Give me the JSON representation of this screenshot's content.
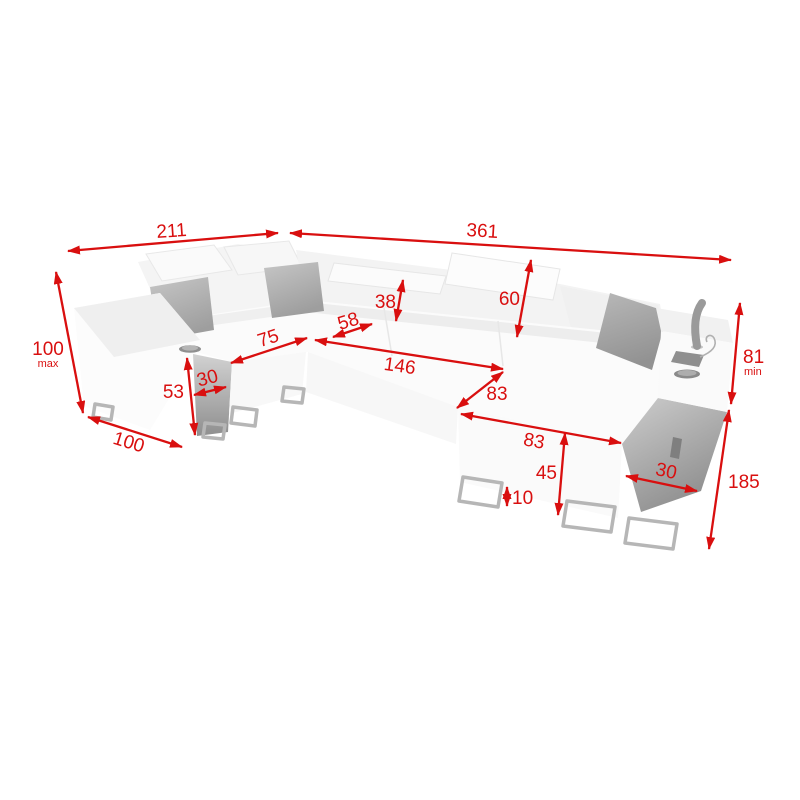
{
  "accent_color": "#d90f0f",
  "colors": {
    "sofa_light": "#fbfbfb",
    "sofa_shadow": "#ededed",
    "pillow_gray": "#ababab",
    "console_gray": "#9a9a9a",
    "metal_gray": "#b6b6b6"
  },
  "dims": {
    "w_left": {
      "value": "211"
    },
    "w_right": {
      "value": "361"
    },
    "h_back_max": {
      "value": "100",
      "qualifier": "max"
    },
    "headrest": {
      "value": "38"
    },
    "backrest": {
      "value": "60"
    },
    "corner_gap": {
      "value": "58"
    },
    "seat_left": {
      "value": "75"
    },
    "seat_long": {
      "value": "146"
    },
    "sleep_depth": {
      "value": "83"
    },
    "sleep_width": {
      "value": "83"
    },
    "console_h": {
      "value": "53"
    },
    "console_w": {
      "value": "30"
    },
    "depth_left": {
      "value": "100"
    },
    "seat_h": {
      "value": "45"
    },
    "leg_h": {
      "value": "10"
    },
    "storage_w": {
      "value": "30"
    },
    "h_arm_min": {
      "value": "81",
      "qualifier": "min"
    },
    "depth_right": {
      "value": "185"
    }
  }
}
